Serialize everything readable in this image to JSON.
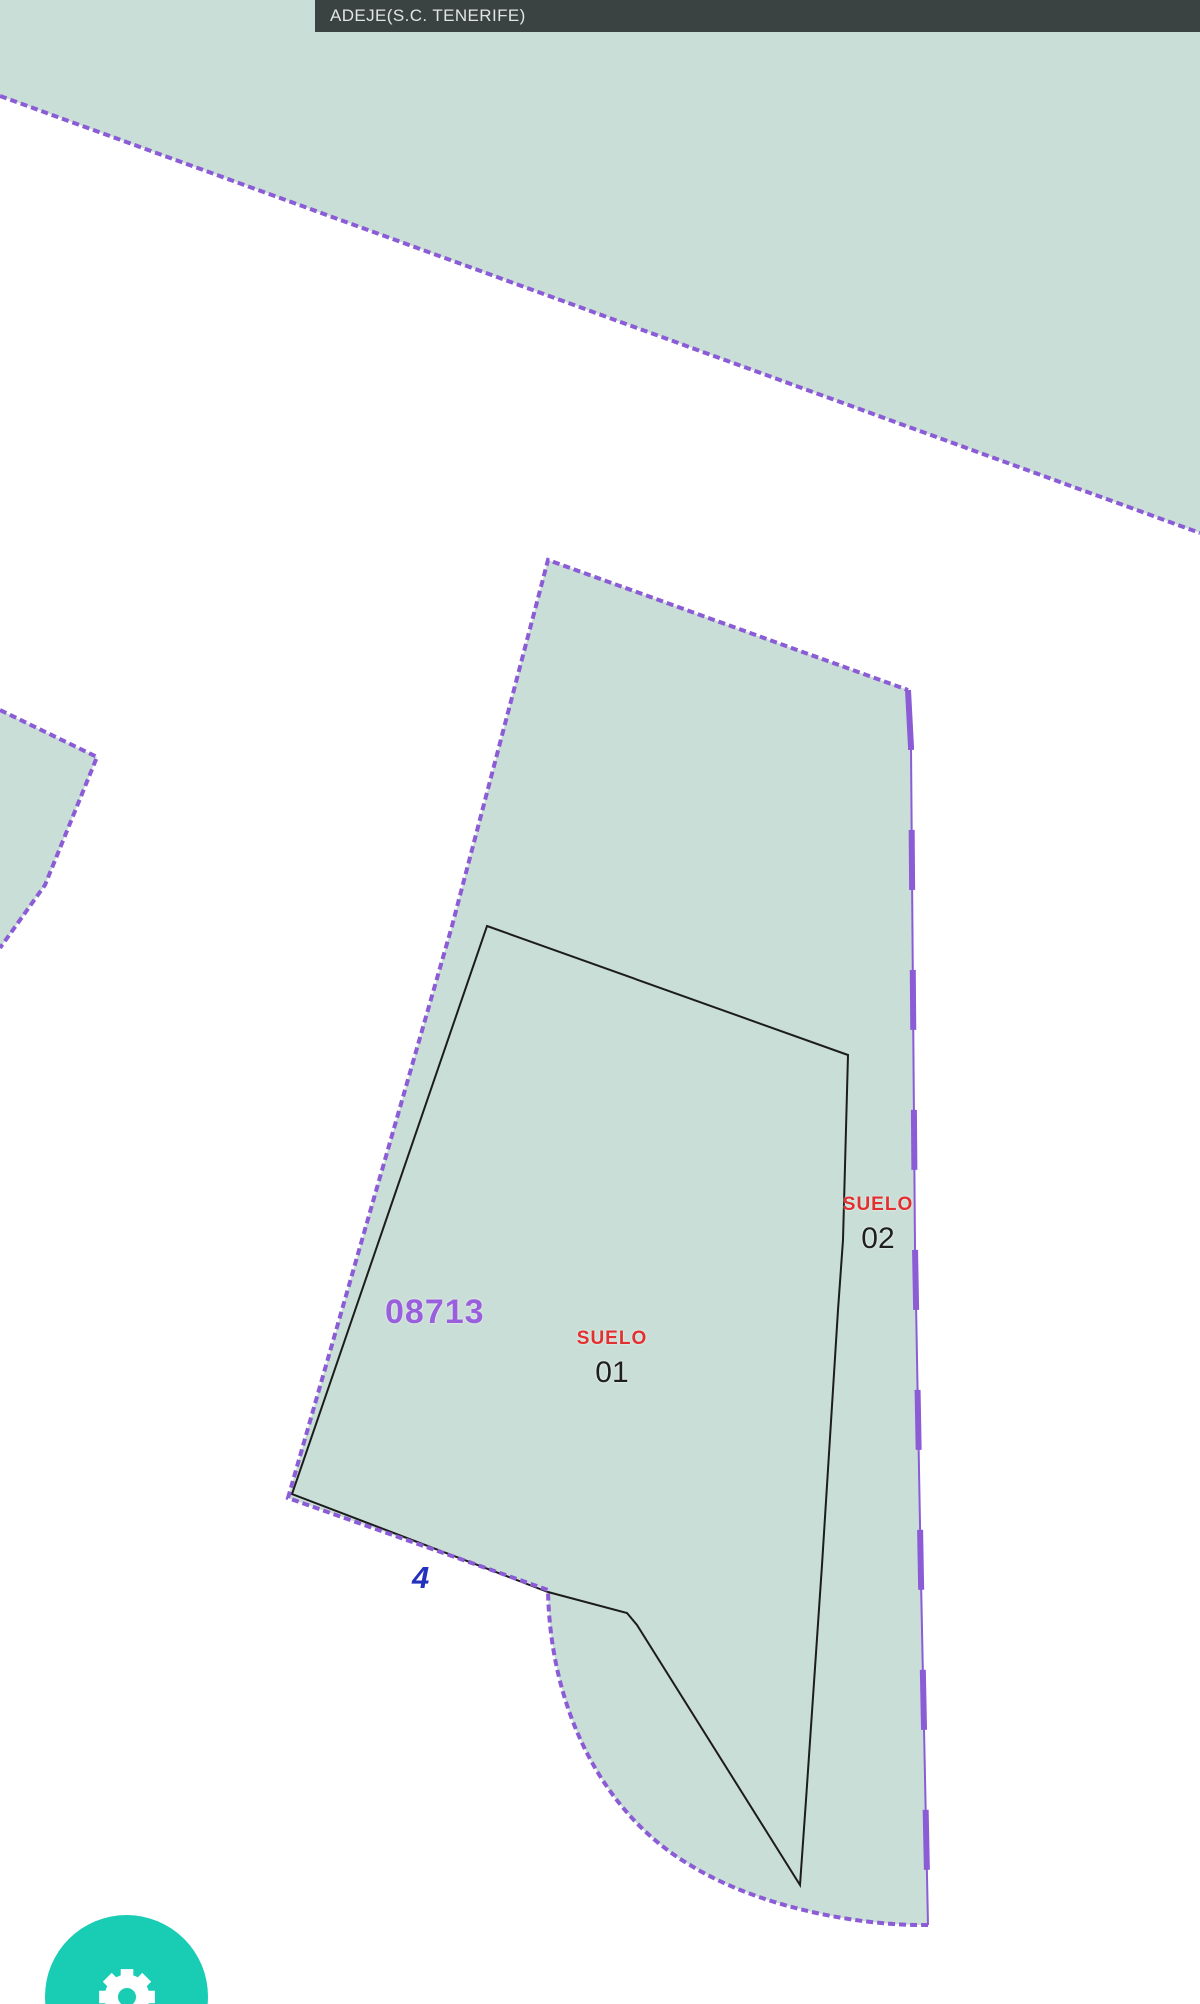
{
  "header": {
    "title": "ADEJE(S.C. TENERIFE)"
  },
  "map": {
    "parcel_label": "08713",
    "subparcel_01": {
      "category": "SUELO",
      "number": "01"
    },
    "subparcel_02": {
      "category": "SUELO",
      "number": "02"
    },
    "address_number": "4",
    "colors": {
      "parcel_fill": "#c9ded6",
      "boundary_purple": "#8b5cd6",
      "inner_line_black": "#1c1c1c",
      "parcel_label_purple": "#9a5fdd",
      "subparcel_label_red": "#e23030",
      "address_number_blue": "#2531be",
      "municipality_bar_bg": "#3b4242",
      "fab_teal": "#19cdb4"
    }
  },
  "fab": {
    "icon_label": "gear"
  }
}
